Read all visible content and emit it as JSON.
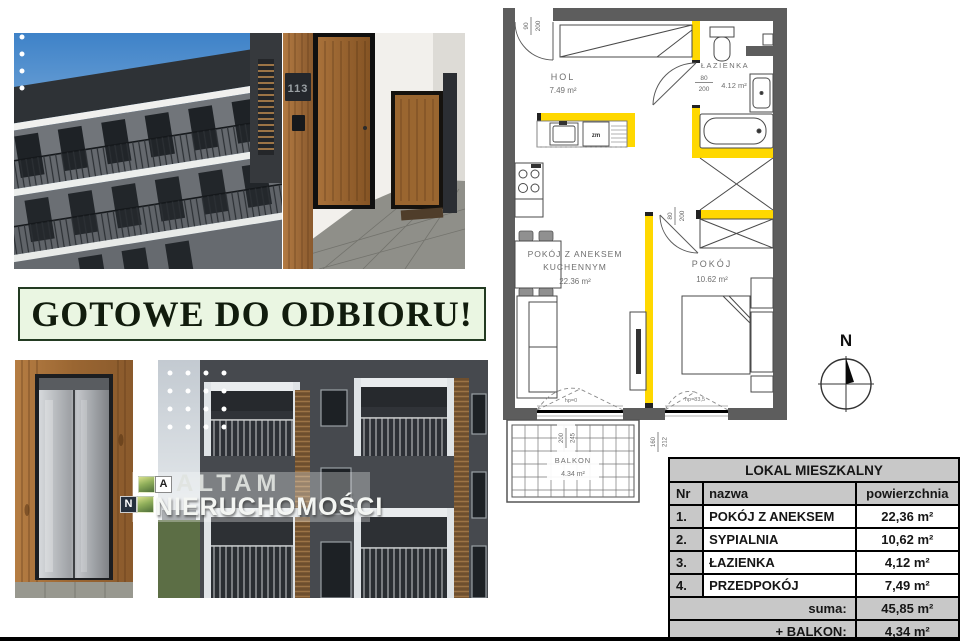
{
  "banner": {
    "text": "GOTOWE DO ODBIORU!"
  },
  "brand": {
    "letter_a": "A",
    "letter_n": "N",
    "name_top": "ALTAM",
    "name_bottom": "NIERUCHOMOŚCI"
  },
  "photos": {
    "hallway_door_plate": "113"
  },
  "floor_plan": {
    "rooms": {
      "hol": {
        "name": "HOL",
        "area": "7.49 m²"
      },
      "lazienka": {
        "name": "ŁAZIENKA",
        "area": "4.12 m²"
      },
      "salon": {
        "name_line1": "POKÓJ Z ANEKSEM",
        "name_line2": "KUCHENNYM",
        "area": "22.36 m²"
      },
      "pokoj": {
        "name": "POKÓJ",
        "area": "10.62 m²"
      },
      "balkon": {
        "name": "BALKON",
        "area": "4.34 m²"
      }
    },
    "dims": {
      "entrance_w": "90",
      "entrance_h": "200",
      "bath_door_w": "80",
      "bath_door_h": "200",
      "bedroom_door_w": "80",
      "bedroom_door_h": "200",
      "balcony_door_w": "200",
      "balcony_door_h": "245",
      "bedroom_window_w": "160",
      "bedroom_window_h": "212",
      "sill_left": "hp=0",
      "sill_right": "hp=83,5"
    },
    "labels": {
      "dishwasher": "zm"
    },
    "compass_north": "N",
    "colors": {
      "wall": "#5d5d5d",
      "highlight": "#ffd800"
    }
  },
  "area_table": {
    "title": "LOKAL MIESZKALNY",
    "columns": {
      "nr": "Nr",
      "name": "nazwa",
      "area": "powierzchnia"
    },
    "rows": [
      {
        "nr": "1.",
        "name": "POKÓJ Z ANEKSEM",
        "area": "22,36 m²"
      },
      {
        "nr": "2.",
        "name": "SYPIALNIA",
        "area": "10,62 m²"
      },
      {
        "nr": "3.",
        "name": "ŁAZIENKA",
        "area": "4,12 m²"
      },
      {
        "nr": "4.",
        "name": "PRZEDPOKÓJ",
        "area": "7,49 m²"
      }
    ],
    "sum_label": "suma:",
    "sum_value": "45,85 m²",
    "balcony_label": "+ BALKON:",
    "balcony_value": "4,34 m²"
  }
}
